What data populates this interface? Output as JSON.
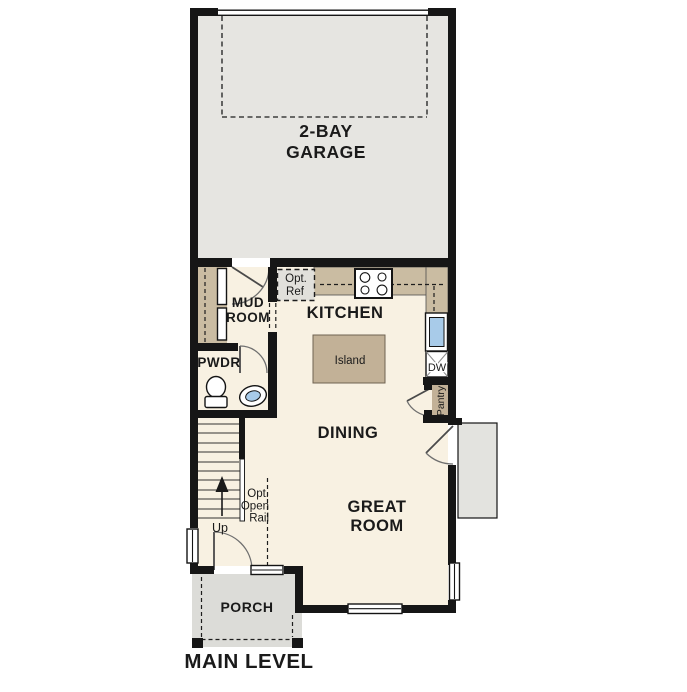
{
  "colors": {
    "wall": "#161616",
    "floor": "#f8f1e2",
    "garage_floor": "#e6e5e1",
    "porch": "#dcdcd8",
    "stoop": "#e3e3df",
    "counter": "#cabca2",
    "island": "#c2b197",
    "appliance": "#e1e0db",
    "sink": "#a8cbe9",
    "text": "#1a1a1a"
  },
  "plan": {
    "title": "MAIN LEVEL",
    "rooms": {
      "garage": {
        "line1": "2-BAY",
        "line2": "GARAGE"
      },
      "mud_room": {
        "line1": "MUD",
        "line2": "ROOM"
      },
      "kitchen": {
        "label": "KITCHEN"
      },
      "powder": {
        "label": "PWDR"
      },
      "dining": {
        "label": "DINING"
      },
      "great_room": {
        "line1": "GREAT",
        "line2": "ROOM"
      },
      "porch": {
        "label": "PORCH"
      },
      "pantry": {
        "label": "Pantry"
      }
    },
    "features": {
      "island": {
        "label": "Island"
      },
      "opt_ref": {
        "line1": "Opt.",
        "line2": "Ref"
      },
      "dishwasher": {
        "label": "DW"
      },
      "stairs": {
        "up": "Up"
      },
      "opt_rail": {
        "line1": "Opt.",
        "line2": "Open",
        "line3": "Rail"
      }
    }
  }
}
